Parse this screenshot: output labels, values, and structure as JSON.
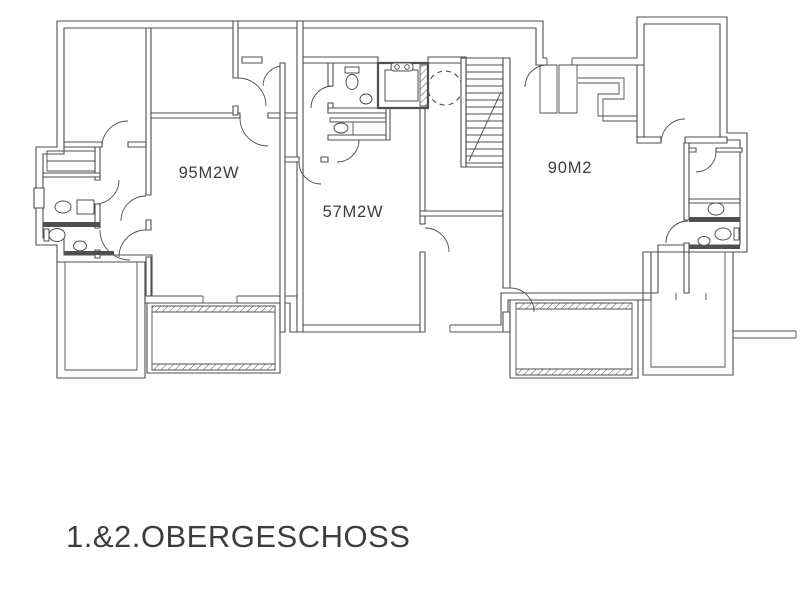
{
  "floorplan": {
    "title": "1.&2.OBERGESCHOSS",
    "unit_left_label": "95M2W",
    "unit_middle_label": "57M2W",
    "unit_right_label": "90M2",
    "colors": {
      "ink": "#4f4f4f",
      "paper": "#ffffff"
    }
  }
}
